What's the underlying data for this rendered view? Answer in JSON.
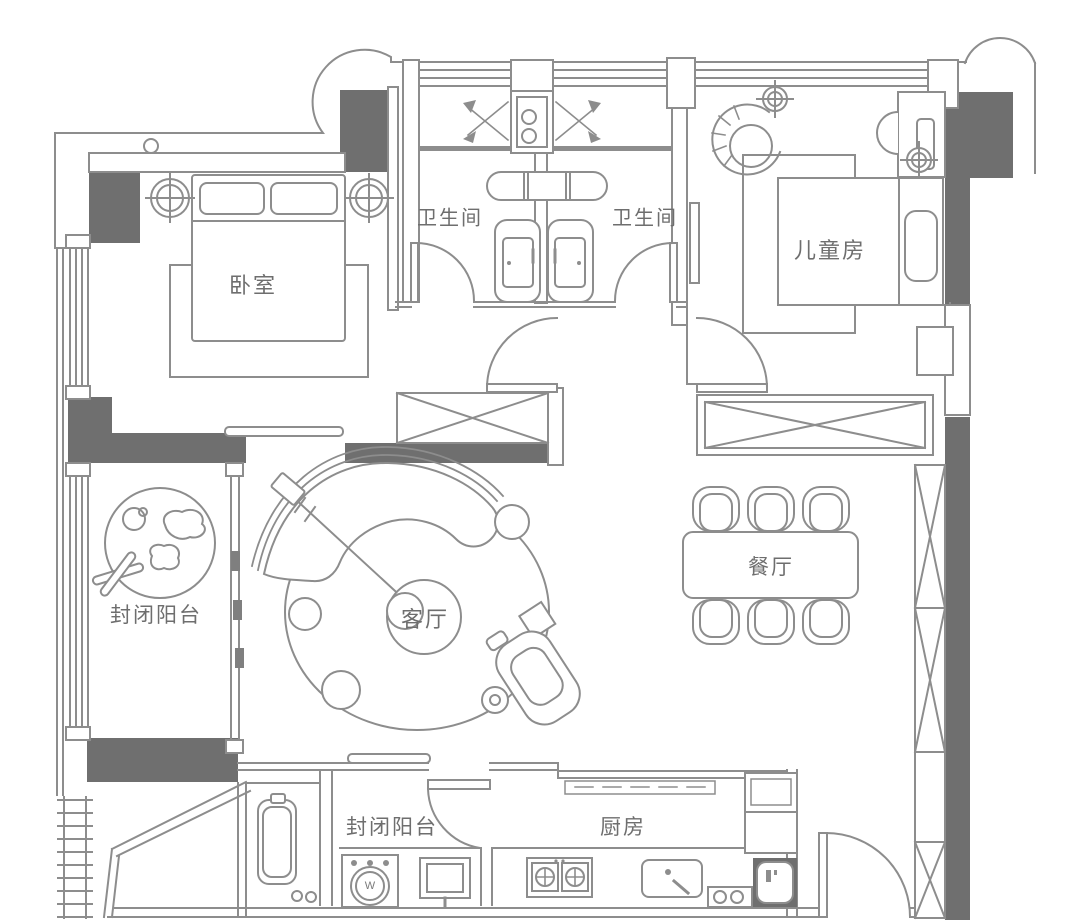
{
  "floor_plan": {
    "type": "apartment-floor-plan",
    "colors": {
      "background": "#ffffff",
      "wall_fill": "#6f6f6f",
      "line": "#8d8d8d",
      "text": "#6e6e6e"
    },
    "labels": {
      "bedroom": "卧室",
      "bathroom_left": "卫生间",
      "bathroom_right": "卫生间",
      "kids_room": "儿童房",
      "balcony_left": "封闭阳台",
      "living_room": "客厅",
      "dining_room": "餐厅",
      "balcony_bottom": "封闭阳台",
      "kitchen": "厨房",
      "washer": "W"
    },
    "rooms": [
      {
        "id": "bedroom",
        "label": "卧室"
      },
      {
        "id": "bathroom-left",
        "label": "卫生间"
      },
      {
        "id": "bathroom-right",
        "label": "卫生间"
      },
      {
        "id": "kids-room",
        "label": "儿童房"
      },
      {
        "id": "balcony-left",
        "label": "封闭阳台"
      },
      {
        "id": "living-room",
        "label": "客厅"
      },
      {
        "id": "dining-room",
        "label": "餐厅"
      },
      {
        "id": "balcony-bottom",
        "label": "封闭阳台"
      },
      {
        "id": "kitchen",
        "label": "厨房"
      }
    ]
  }
}
